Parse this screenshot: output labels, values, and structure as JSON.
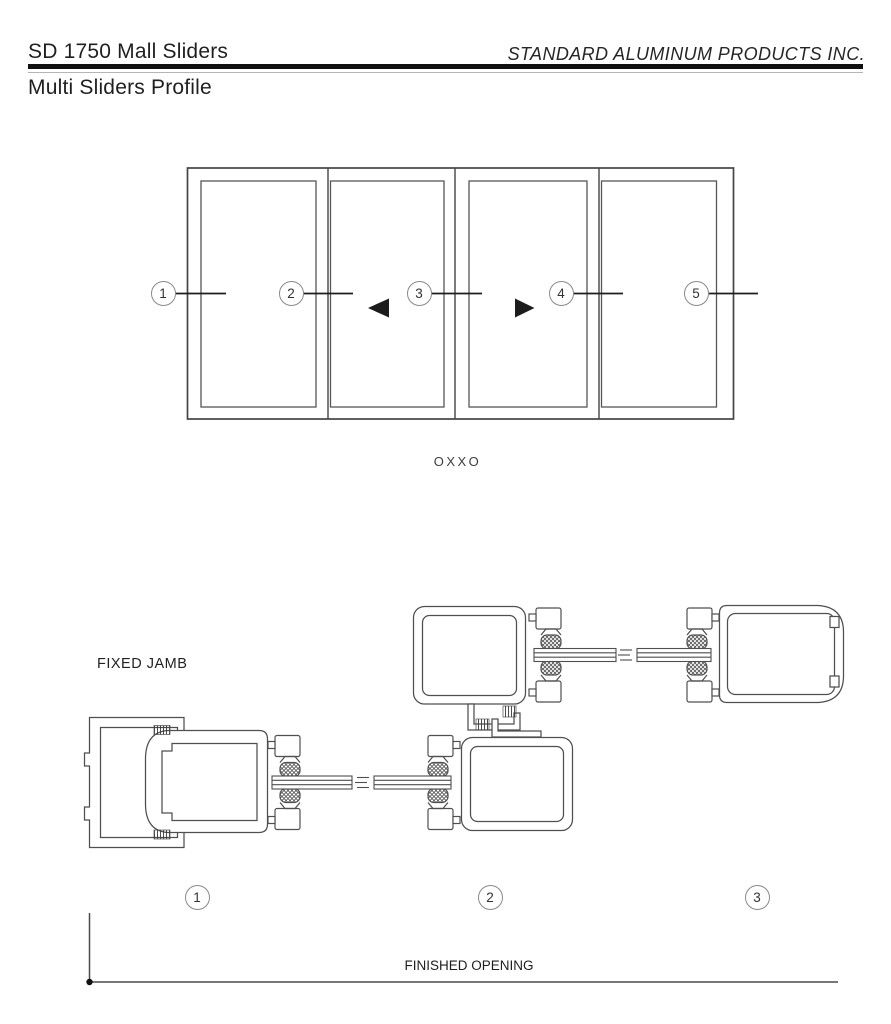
{
  "header": {
    "title": "SD 1750 Mall Sliders",
    "company": "STANDARD ALUMINUM PRODUCTS INC.",
    "subtitle": "Multi Sliders Profile"
  },
  "elevation": {
    "config_label": "OXXO",
    "callouts": [
      "1",
      "2",
      "3",
      "4",
      "5"
    ]
  },
  "sections": {
    "fixed_jamb_label": "FIXED JAMB",
    "callouts": [
      "1",
      "2",
      "3"
    ],
    "dimension_label": "FINISHED OPENING"
  },
  "colors": {
    "line_dark": "#1d1d1d",
    "line_frame": "#454545",
    "line_profile": "#4f4f4f",
    "circle_stroke": "#8a8a8a"
  }
}
